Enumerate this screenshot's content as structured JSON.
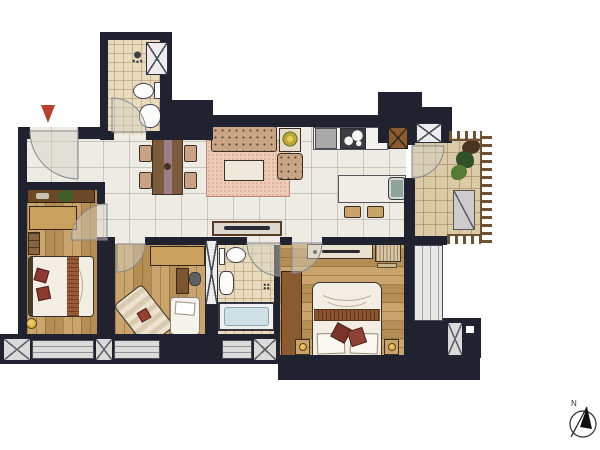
{
  "compass": {
    "label": "N"
  },
  "palette": {
    "wall": "#212230",
    "marble": "#edebe4",
    "wood": "#c49a5c",
    "tile": "#e9dcbe",
    "balcony_tile": "#dbcaa6",
    "rug": "#eecbb9",
    "sofa": "#c9a585",
    "red": "#b5402f",
    "window": "#dcdcda",
    "tub": "#cfe0e7",
    "gold": "#d9ab3c",
    "railing": "#6b5334"
  },
  "icons": {
    "entrance_marker": "red-triangle-down",
    "compass": "north-arrow",
    "columns": "x-cross-box",
    "stove": "two-burner-cooktop",
    "shower": "shower-head",
    "drain": "floor-drain"
  }
}
